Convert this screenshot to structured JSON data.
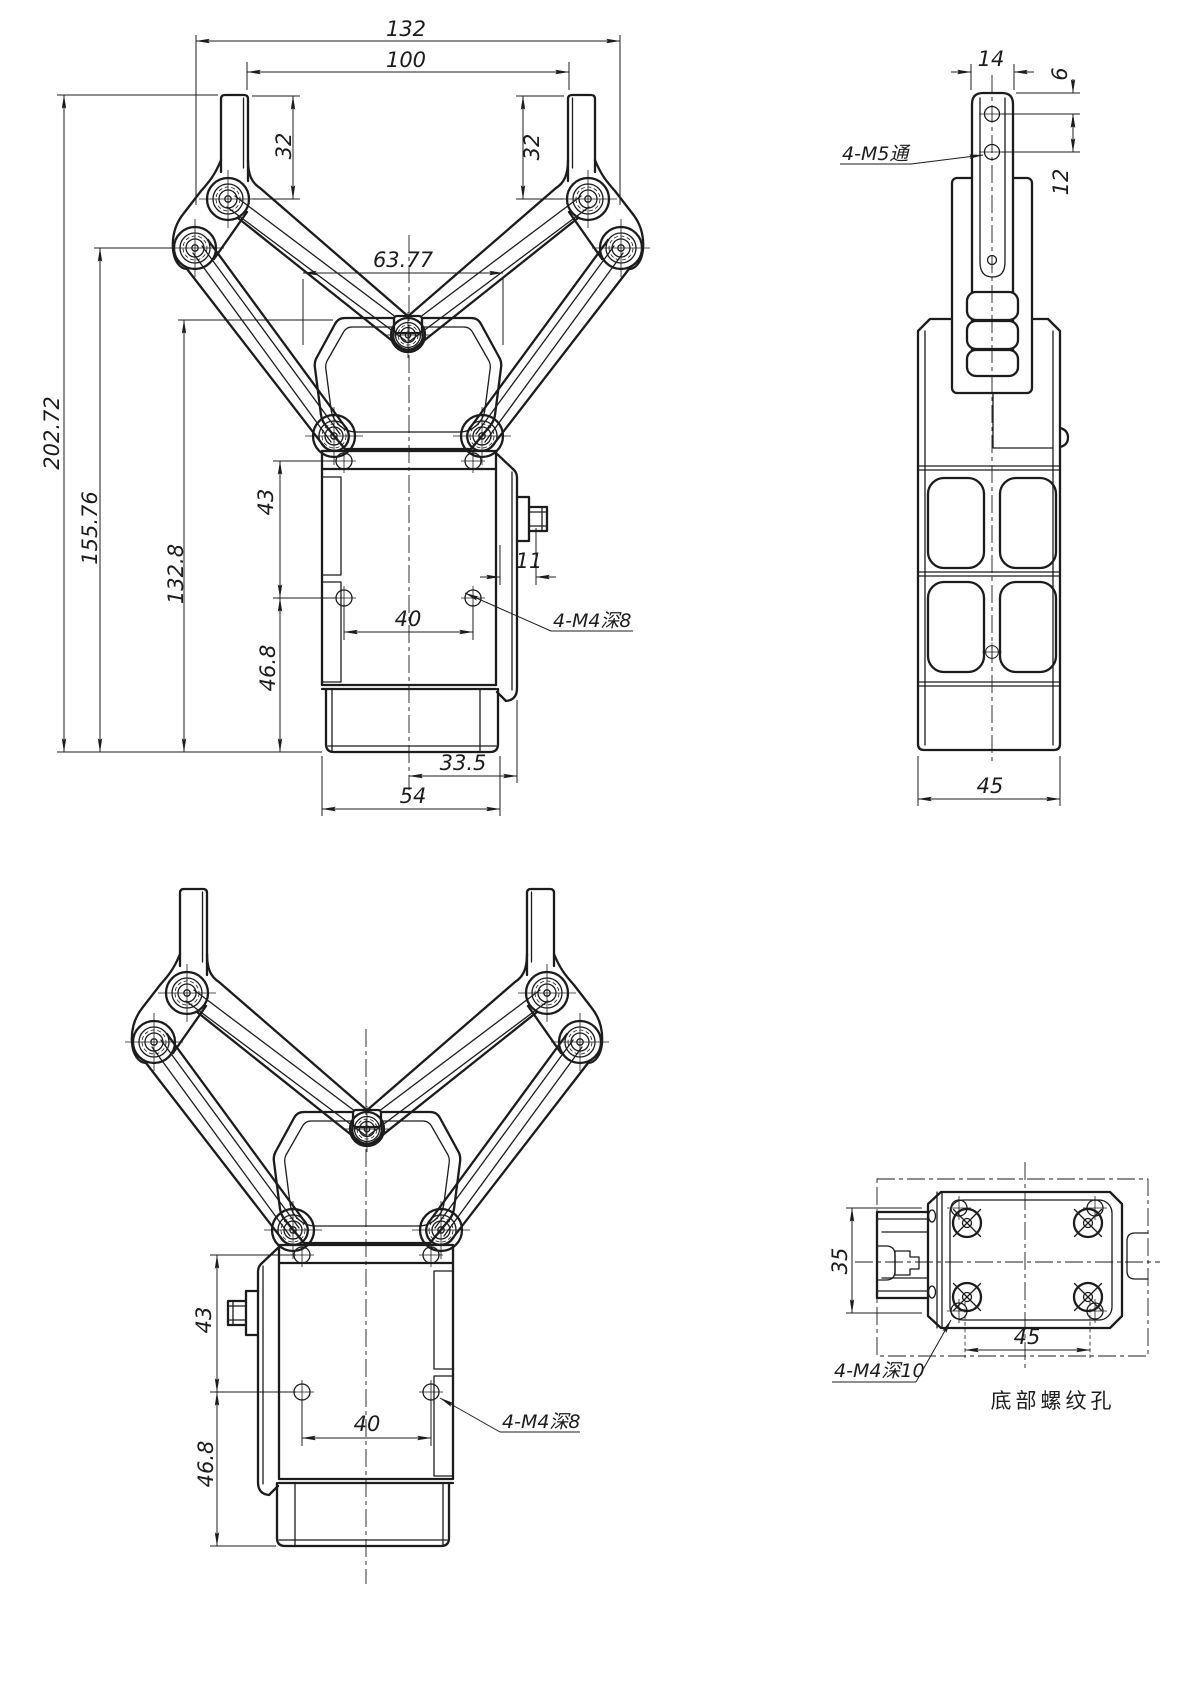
{
  "colors": {
    "ink": "#1c1c1c",
    "paper": "#ffffff"
  },
  "views": {
    "front_open": {
      "callout": "4-M4深8",
      "dims": {
        "overall_width": "132",
        "opening_width": "100",
        "finger_len_left": "32",
        "finger_len_right": "32",
        "link_span": "63.77",
        "overall_height": "202.72",
        "pivot_height": "155.76",
        "body_top_height": "132.8",
        "mount_hole_vspace": "43",
        "mount_hole_hspace": "40",
        "base_section_height": "46.8",
        "connector_protrusion": "11",
        "connector_offset": "33.5",
        "body_width": "54"
      }
    },
    "side": {
      "callout": "4-M5通",
      "dims": {
        "fingertip_width": "14",
        "tip_hole_offset": "6",
        "tip_hole_pitch": "12",
        "body_depth": "45"
      }
    },
    "front_mirrored": {
      "callout": "4-M4深8",
      "dims": {
        "mount_hole_vspace": "43",
        "mount_hole_hspace": "40",
        "base_section_height": "46.8"
      }
    },
    "bottom": {
      "callout": "4-M4深10",
      "caption": "底部螺纹孔",
      "dims": {
        "hole_row_spacing": "35",
        "hole_col_spacing": "45"
      }
    }
  }
}
